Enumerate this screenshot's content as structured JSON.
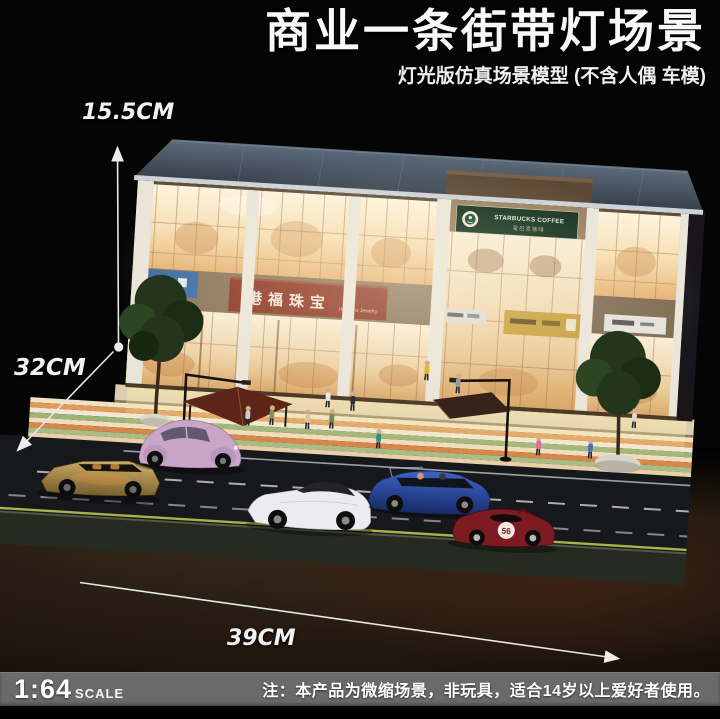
{
  "header": {
    "title": "商业一条街带灯场景",
    "subtitle": "灯光版仿真场景模型 (不含人偶 车模)"
  },
  "dimensions": {
    "height": "15.5CM",
    "depth": "32CM",
    "width": "39CM"
  },
  "scene": {
    "signs": {
      "jewelry_cn": "港福珠宝",
      "jewelry_en": "Hong Fu Jewelry",
      "starbucks_en": "STARBUCKS COFFEE",
      "starbucks_cn": "星巴克咖啡"
    },
    "race_car_number": "56"
  },
  "footer": {
    "scale_ratio": "1:64",
    "scale_word": "SCALE",
    "note": "注：本产品为微缩场景，非玩具，适合14岁以上爱好者使用。"
  },
  "colors": {
    "jewelry_sign_red": "#8c3320",
    "starbucks_green": "#13301e",
    "footer_bar_gray": "#6a6a6a",
    "window_glow": "#f5d890"
  }
}
